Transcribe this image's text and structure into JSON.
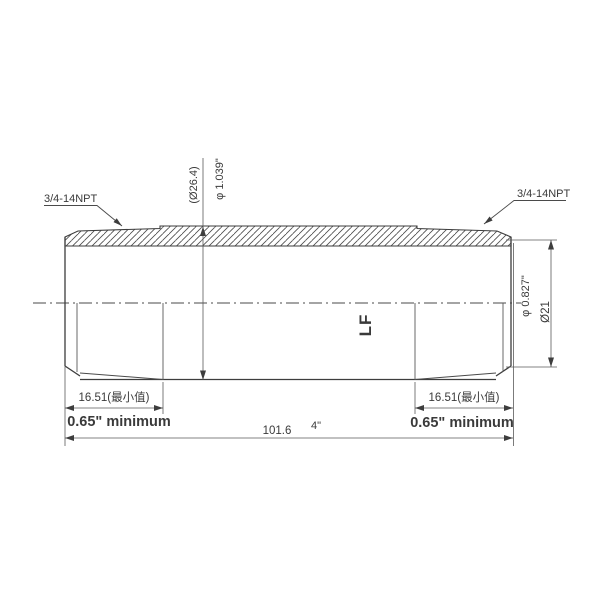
{
  "page": {
    "background": "#ffffff"
  },
  "drawing": {
    "line_color": "#454545",
    "labels": {
      "thread_left": "3/4-14NPT",
      "thread_right": "3/4-14NPT",
      "od_metric": "(Ø26.4)",
      "od_inch": "φ 1.039\"",
      "end_diameter_inch": "φ 0.827\"",
      "end_diameter_metric": "Ø21",
      "thread_length_metric_left": "16.51(最小值)",
      "thread_length_inch_left": "0.65\" minimum",
      "thread_length_metric_right": "16.51(最小值)",
      "thread_length_inch_right": "0.65\" minimum",
      "overall_length_metric": "101.6",
      "overall_length_inch": "4\"",
      "body_mark": "LF"
    }
  }
}
